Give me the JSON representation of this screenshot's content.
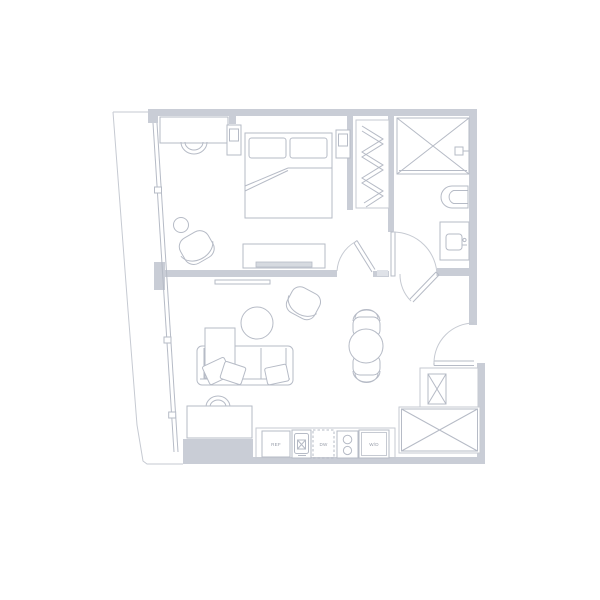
{
  "floorplan": {
    "type": "apartment-floor-plan",
    "labels": {
      "refrigerator": "REF",
      "dishwasher": "DW",
      "washer_dryer": "W/D"
    },
    "rooms": [
      "bedroom",
      "living-room",
      "kitchen",
      "bathroom",
      "closet",
      "entry-vestibule"
    ],
    "colors": {
      "wall": "#c9cdd6",
      "wall_light": "#dfe2e8",
      "line": "#b6bbc6",
      "line_faint": "#c6cad2",
      "tv_fill": "#d6dae0",
      "label_text": "#969ca8",
      "background": "#ffffff"
    }
  }
}
